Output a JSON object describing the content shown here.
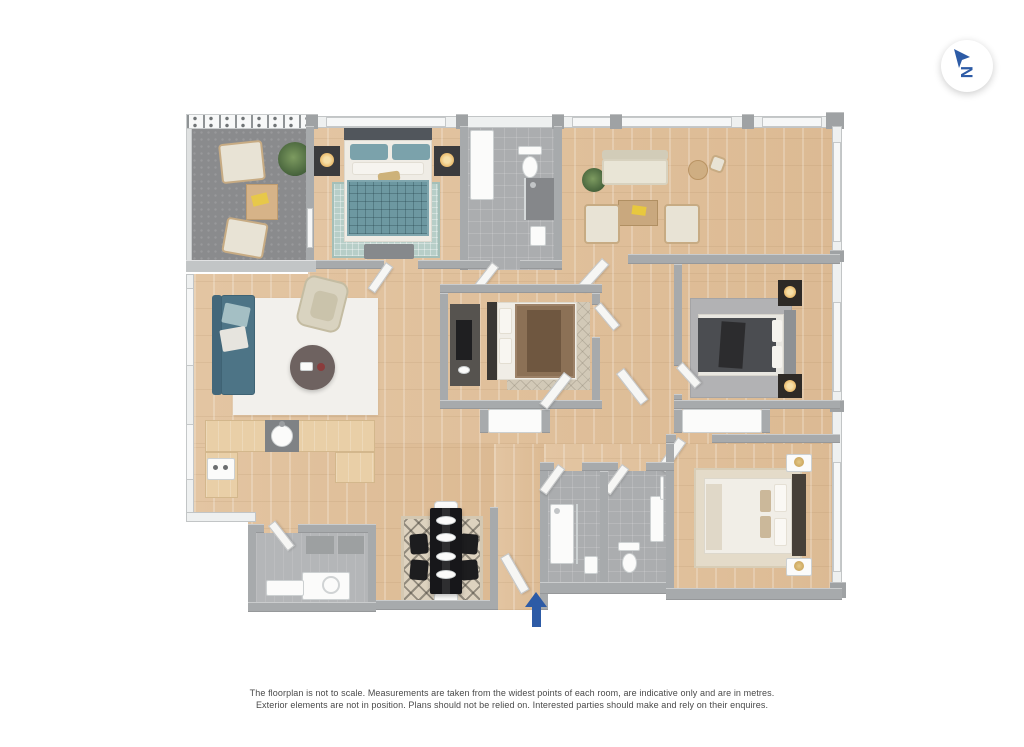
{
  "page": {
    "background_color": "#ffffff"
  },
  "compass": {
    "letter": "N",
    "color": "#2d5ba6",
    "background": "#ffffff"
  },
  "entrance": {
    "symbol": "up-arrow",
    "color": "#2d5ba6"
  },
  "disclaimer": {
    "line1": "The floorplan is not to scale. Measurements are taken from the widest points of each room, are indicative only and are in metres.",
    "line2": "Exterior elements are not in position. Plans should not be relied on. Interested parties should make and rely on their enquires."
  },
  "palette": {
    "wood_floor": "#e0c19e",
    "terrace_floor": "#8a8b8d",
    "bathroom_tile": "#abadaf",
    "wall_interior": "#a7aaac",
    "wall_exterior": "#eef0f0",
    "window": "#f6f7f7",
    "accent_blue": "#2d5ba6",
    "sofa_teal": "#4d7486",
    "bed_teal": "#6d98a1",
    "bed_brown": "#8c7156",
    "bed_charcoal": "#4b4d51",
    "bed_white": "#f1eee7",
    "rug_white": "#f2f0ec",
    "rug_sage": "#b7cec8",
    "rug_gray": "#b2b2b4",
    "rug_beige": "#e4dbc9",
    "dining_table_black": "#17171a",
    "counter_wood": "#e9cfa7",
    "lamp_glow": "#f2c886"
  },
  "floorplan": {
    "rooms": [
      {
        "id": "terrace",
        "floor": "terrace_floor",
        "furniture": [
          "armchair",
          "armchair",
          "coffee-table",
          "plant",
          "railing"
        ]
      },
      {
        "id": "bedroom-1",
        "floor": "wood_floor",
        "furniture": [
          "double-bed-teal",
          "nightstand-lamp",
          "nightstand-lamp",
          "bench",
          "rug-sage"
        ]
      },
      {
        "id": "bathroom-1",
        "floor": "bathroom_tile",
        "furniture": [
          "toilet",
          "shower",
          "basin",
          "cabinet"
        ]
      },
      {
        "id": "reception",
        "floor": "wood_floor",
        "furniture": [
          "sofa-cream",
          "armchair",
          "armchair",
          "coffee-table",
          "bistro-table",
          "bistro-chair",
          "plant"
        ]
      },
      {
        "id": "living-room",
        "floor": "wood_floor",
        "furniture": [
          "sofa-teal",
          "armchair-cream",
          "round-coffee-table",
          "rug-white"
        ]
      },
      {
        "id": "kitchen",
        "floor": "wood_floor",
        "furniture": [
          "l-shaped-counter",
          "round-sink",
          "hob"
        ]
      },
      {
        "id": "utility-room",
        "floor": "bathroom_tile",
        "furniture": [
          "appliance",
          "shelf",
          "cabinet",
          "cabinet"
        ]
      },
      {
        "id": "dining-area",
        "floor": "wood_floor",
        "furniture": [
          "dining-table-black",
          "chair-black",
          "chair-black",
          "chair-black",
          "chair-black",
          "end-seat",
          "end-seat",
          "rug-lattice"
        ]
      },
      {
        "id": "bedroom-2",
        "floor": "wood_floor",
        "furniture": [
          "double-bed-brown",
          "dresser",
          "rug-lattice",
          "wardrobe"
        ]
      },
      {
        "id": "bedroom-3",
        "floor": "wood_floor",
        "furniture": [
          "double-bed-charcoal",
          "nightstand-lamp",
          "nightstand-lamp",
          "rug-gray",
          "wardrobe"
        ]
      },
      {
        "id": "bedroom-4",
        "floor": "wood_floor",
        "furniture": [
          "double-bed-white",
          "nightstand-brass-lamp",
          "nightstand-brass-lamp",
          "rug-beige"
        ]
      },
      {
        "id": "shower-room",
        "floor": "bathroom_tile",
        "furniture": [
          "shower-tray",
          "glass-screen",
          "basin"
        ]
      },
      {
        "id": "wc",
        "floor": "bathroom_tile",
        "furniture": [
          "toilet",
          "basin",
          "towel-rail"
        ]
      }
    ]
  }
}
